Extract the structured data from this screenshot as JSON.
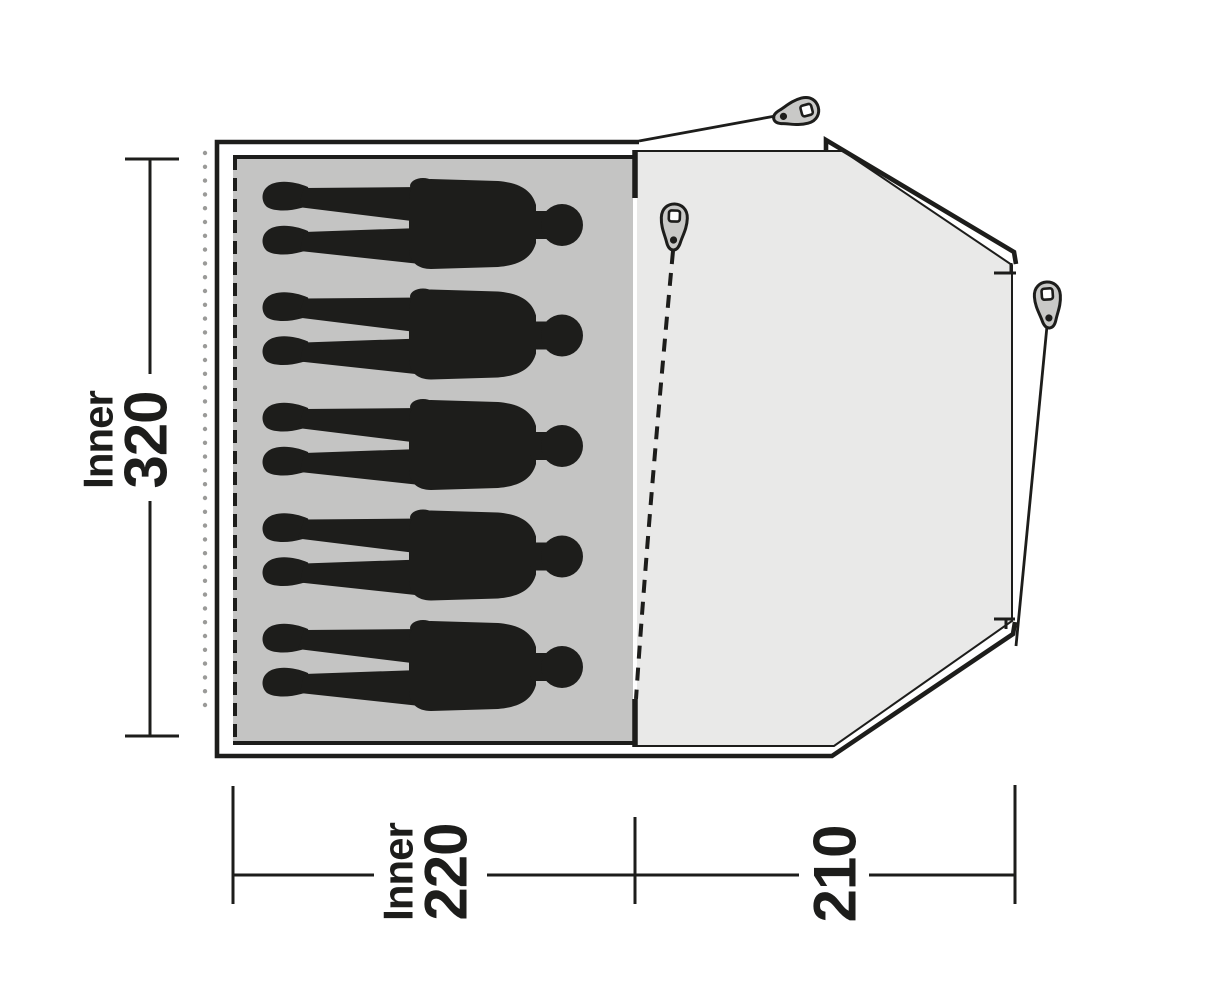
{
  "floorplan": {
    "inner_room": {
      "occupants": 5,
      "dimension_vertical": {
        "word": "Inner",
        "value": "320"
      },
      "dimension_horizontal": {
        "word": "Inner",
        "value": "220"
      }
    },
    "porch": {
      "dimension_horizontal": {
        "value": "210"
      }
    },
    "peg_count": 3,
    "icons": {
      "peg": "tent-peg-icon",
      "person": "person-silhouette"
    },
    "colors": {
      "ink": "#1d1d1b",
      "inner_area": "#c4c4c3",
      "porch_area": "#e9e9e8",
      "dot_gray": "#9a9a98",
      "peg_fill": "#c9c9c7",
      "background": "#ffffff"
    }
  }
}
